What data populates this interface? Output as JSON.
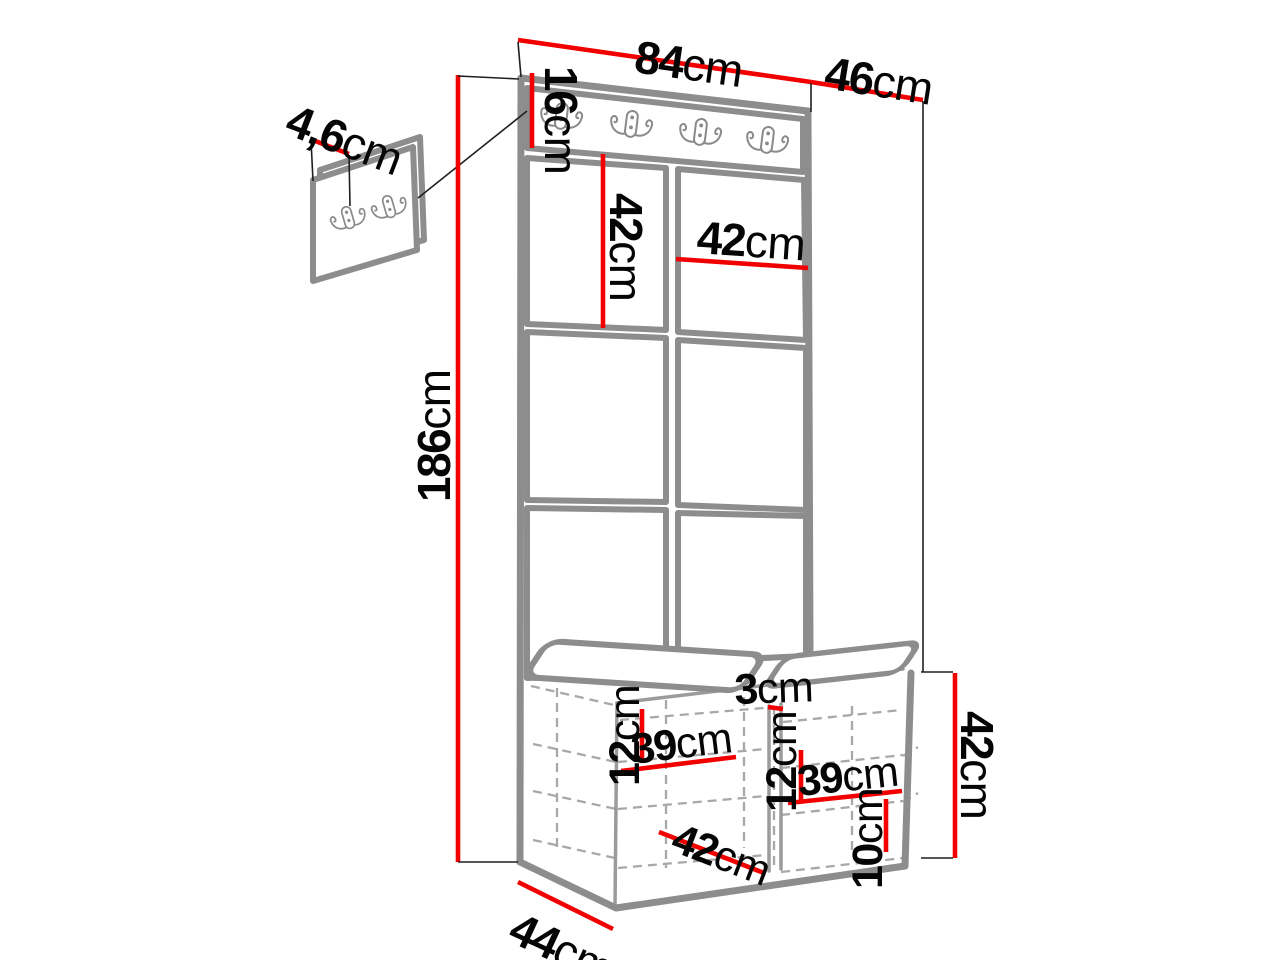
{
  "colors": {
    "dimension_red": "#f20000",
    "outline_gray": "#8d8d8d",
    "line_gray": "#9b9b9b",
    "dashed_gray": "#a8a8a8",
    "ext_black": "#1f1f1f",
    "text_black": "#050505"
  },
  "icons": {
    "coat_hook": "double-prong-coat-hook"
  },
  "hook_rail": {
    "hook_count": 4
  },
  "wall_panel": {
    "hook_count": 2
  },
  "labels": {
    "width_top": {
      "v": "84",
      "u": "cm"
    },
    "depth_top": {
      "v": "46",
      "u": "cm"
    },
    "panel_thickness": {
      "v": "4,6",
      "u": "cm"
    },
    "rail_height": {
      "v": "16",
      "u": "cm"
    },
    "tile_height": {
      "v": "42",
      "u": "cm"
    },
    "tile_width": {
      "v": "42",
      "u": "cm"
    },
    "total_height": {
      "v": "186",
      "u": "cm"
    },
    "seat_gap": {
      "v": "3",
      "u": "cm"
    },
    "left_shelf_spacing": {
      "v": "12",
      "u": "cm"
    },
    "left_shelf_width": {
      "v": "39",
      "u": "cm"
    },
    "right_shelf_spacing": {
      "v": "12",
      "u": "cm"
    },
    "right_shelf_width": {
      "v": "39",
      "u": "cm"
    },
    "bench_opening_width": {
      "v": "42",
      "u": "cm"
    },
    "plinth_height": {
      "v": "10",
      "u": "cm"
    },
    "bench_height": {
      "v": "42",
      "u": "cm"
    },
    "bench_depth": {
      "v": "44",
      "u": "cm"
    }
  }
}
